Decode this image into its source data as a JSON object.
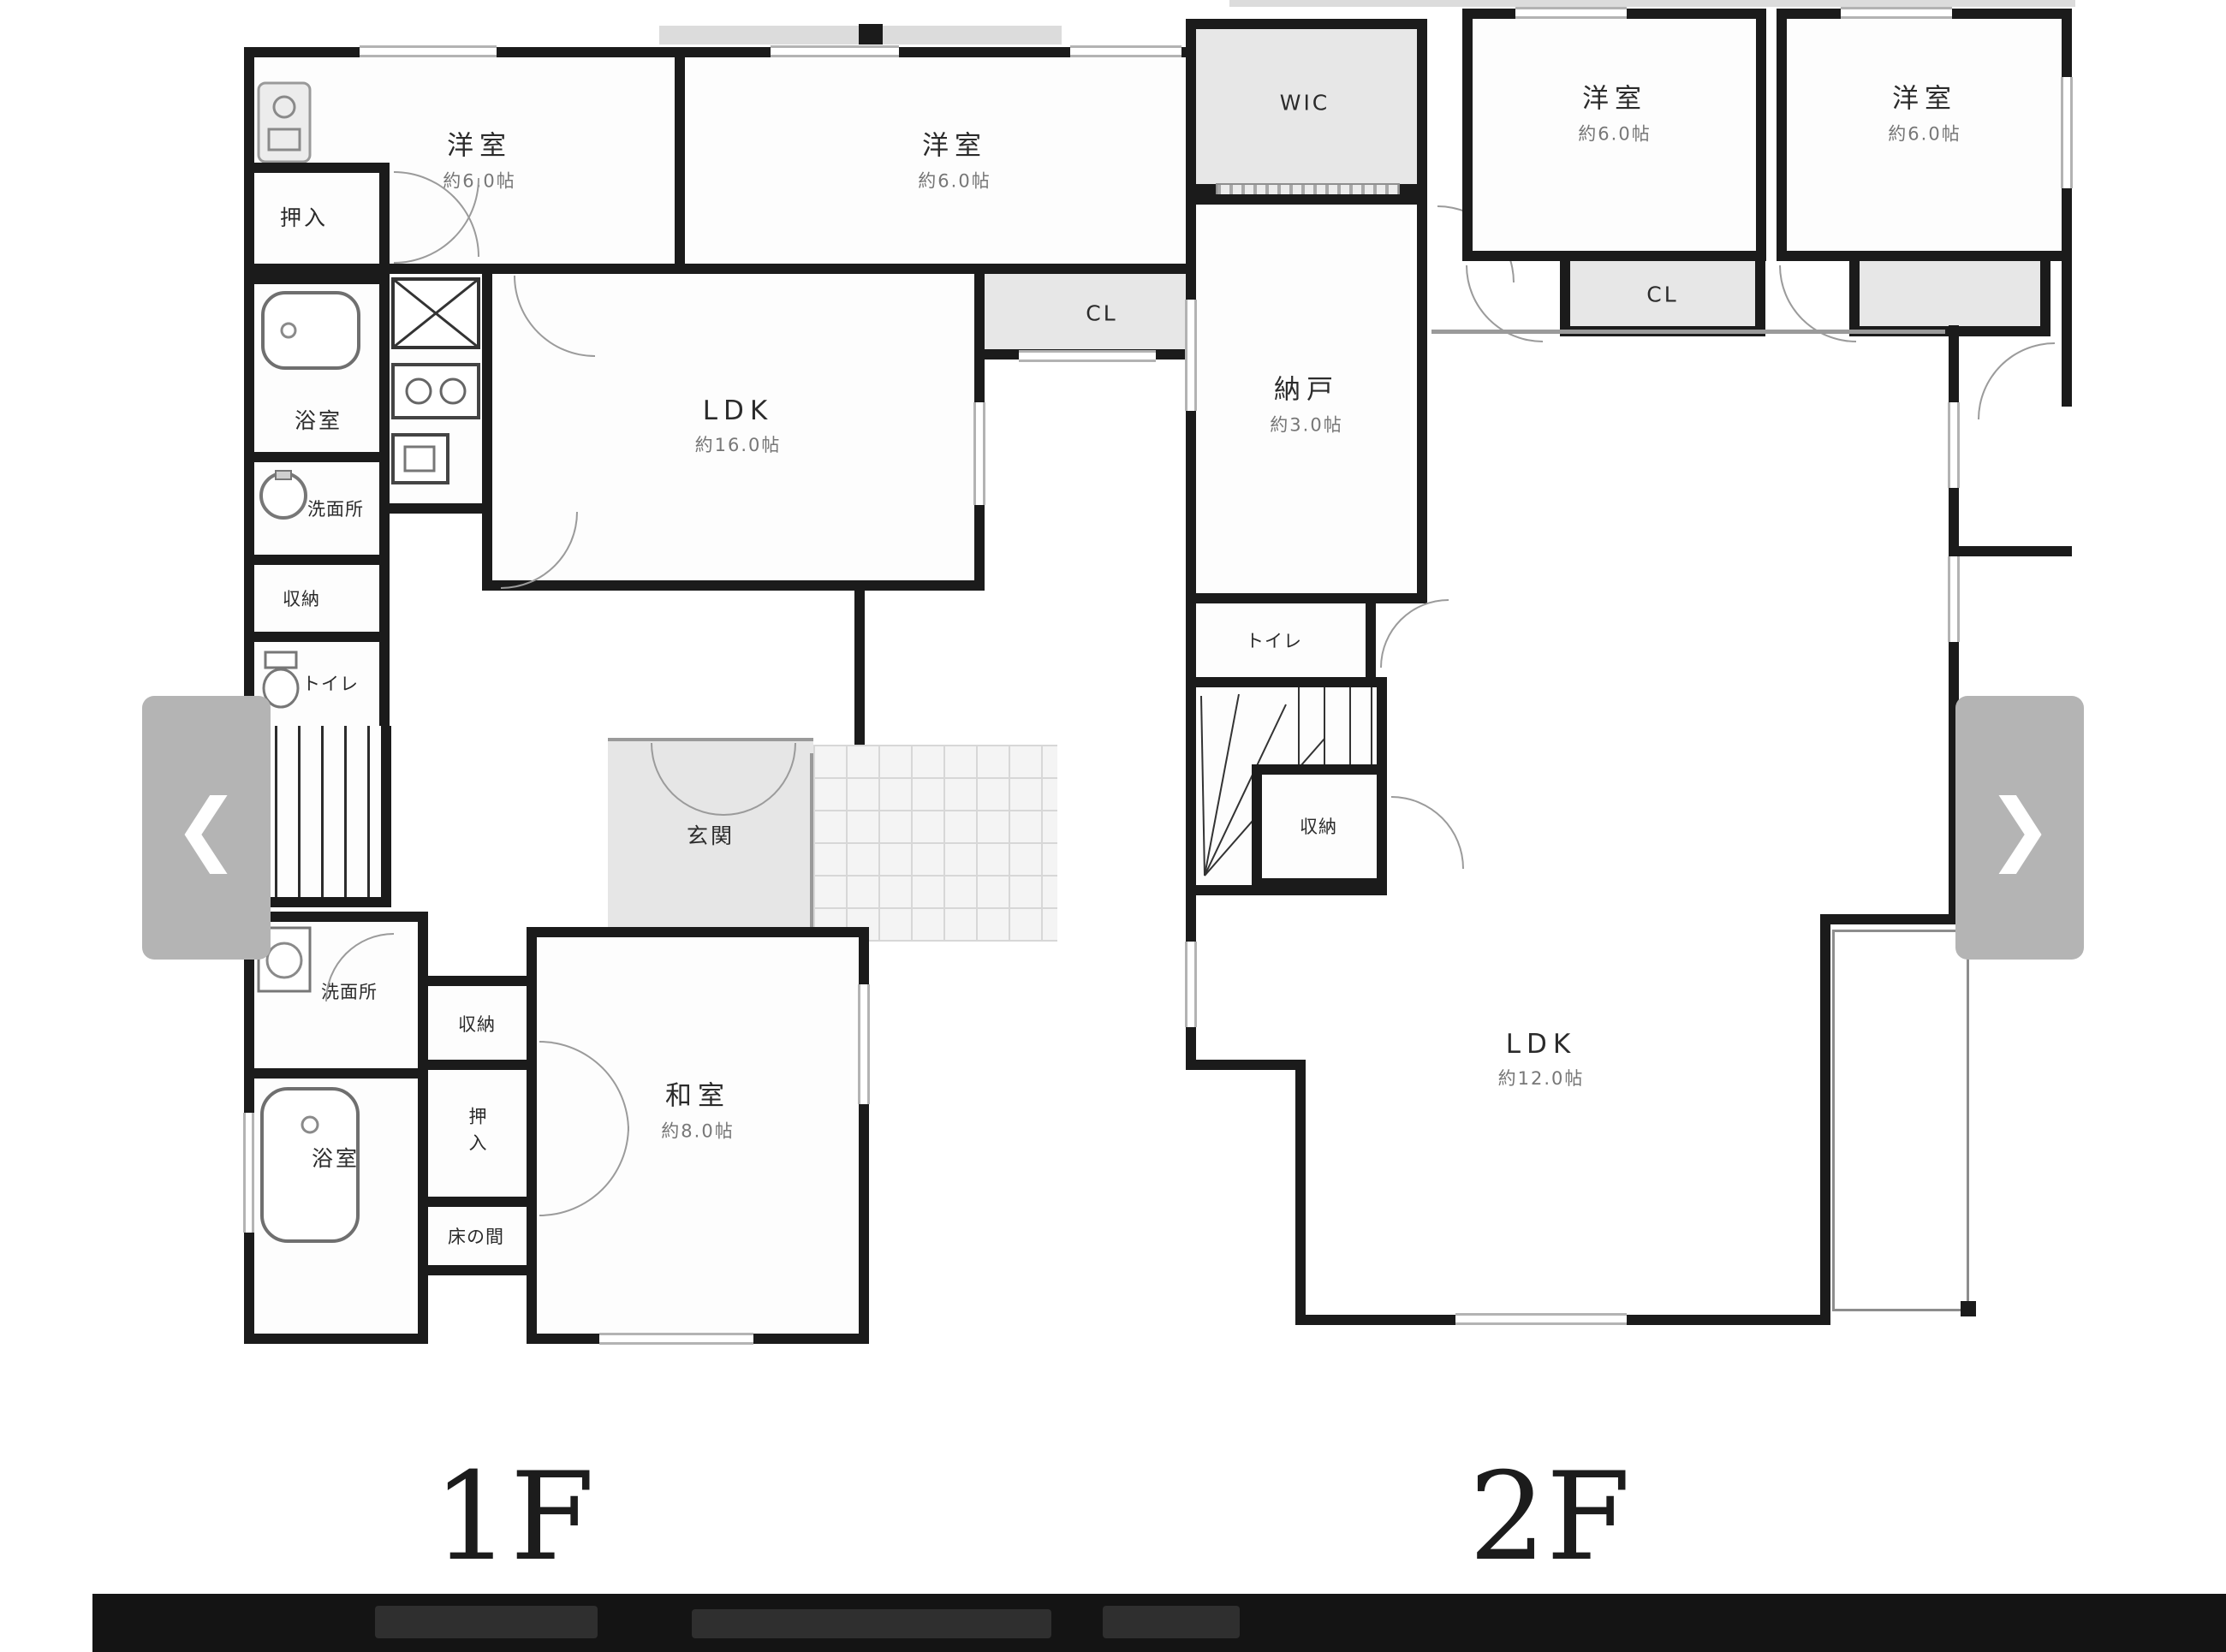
{
  "carousel": {
    "prev_icon": "❮",
    "next_icon": "❯"
  },
  "f1": {
    "floor_label": "1F",
    "yoshitsu1": "洋室",
    "yoshitsu1_size": "約6.0帖",
    "yoshitsu2": "洋室",
    "yoshitsu2_size": "約6.0帖",
    "oshiire1": "押入",
    "cl": "CL",
    "ldk": "LDK",
    "ldk_size": "約16.0帖",
    "bath1": "浴室",
    "senmen1": "洗面所",
    "shuno1": "収納",
    "toilet1": "トイレ",
    "genkan": "玄関",
    "senmen2": "洗面所",
    "bath2": "浴室",
    "shuno2": "収納",
    "oshiire2": "押入",
    "tokonoma": "床の間",
    "washitsu": "和室",
    "washitsu_size": "約8.0帖"
  },
  "f2": {
    "floor_label": "2F",
    "wic": "WIC",
    "nando": "納戸",
    "nando_size": "約3.0帖",
    "toilet": "トイレ",
    "shuno": "収納",
    "yoshitsu1": "洋室",
    "yoshitsu1_size": "約6.0帖",
    "cl": "CL",
    "yoshitsu2": "洋室",
    "yoshitsu2_size": "約6.0帖",
    "ldk": "LDK",
    "ldk_size": "約12.0帖"
  },
  "colors": {
    "wall": "#1b1b1b",
    "closet_fill": "#e7e7e7",
    "arrow_bg": "#b4b4b4",
    "bottom_bar": "#141414"
  }
}
